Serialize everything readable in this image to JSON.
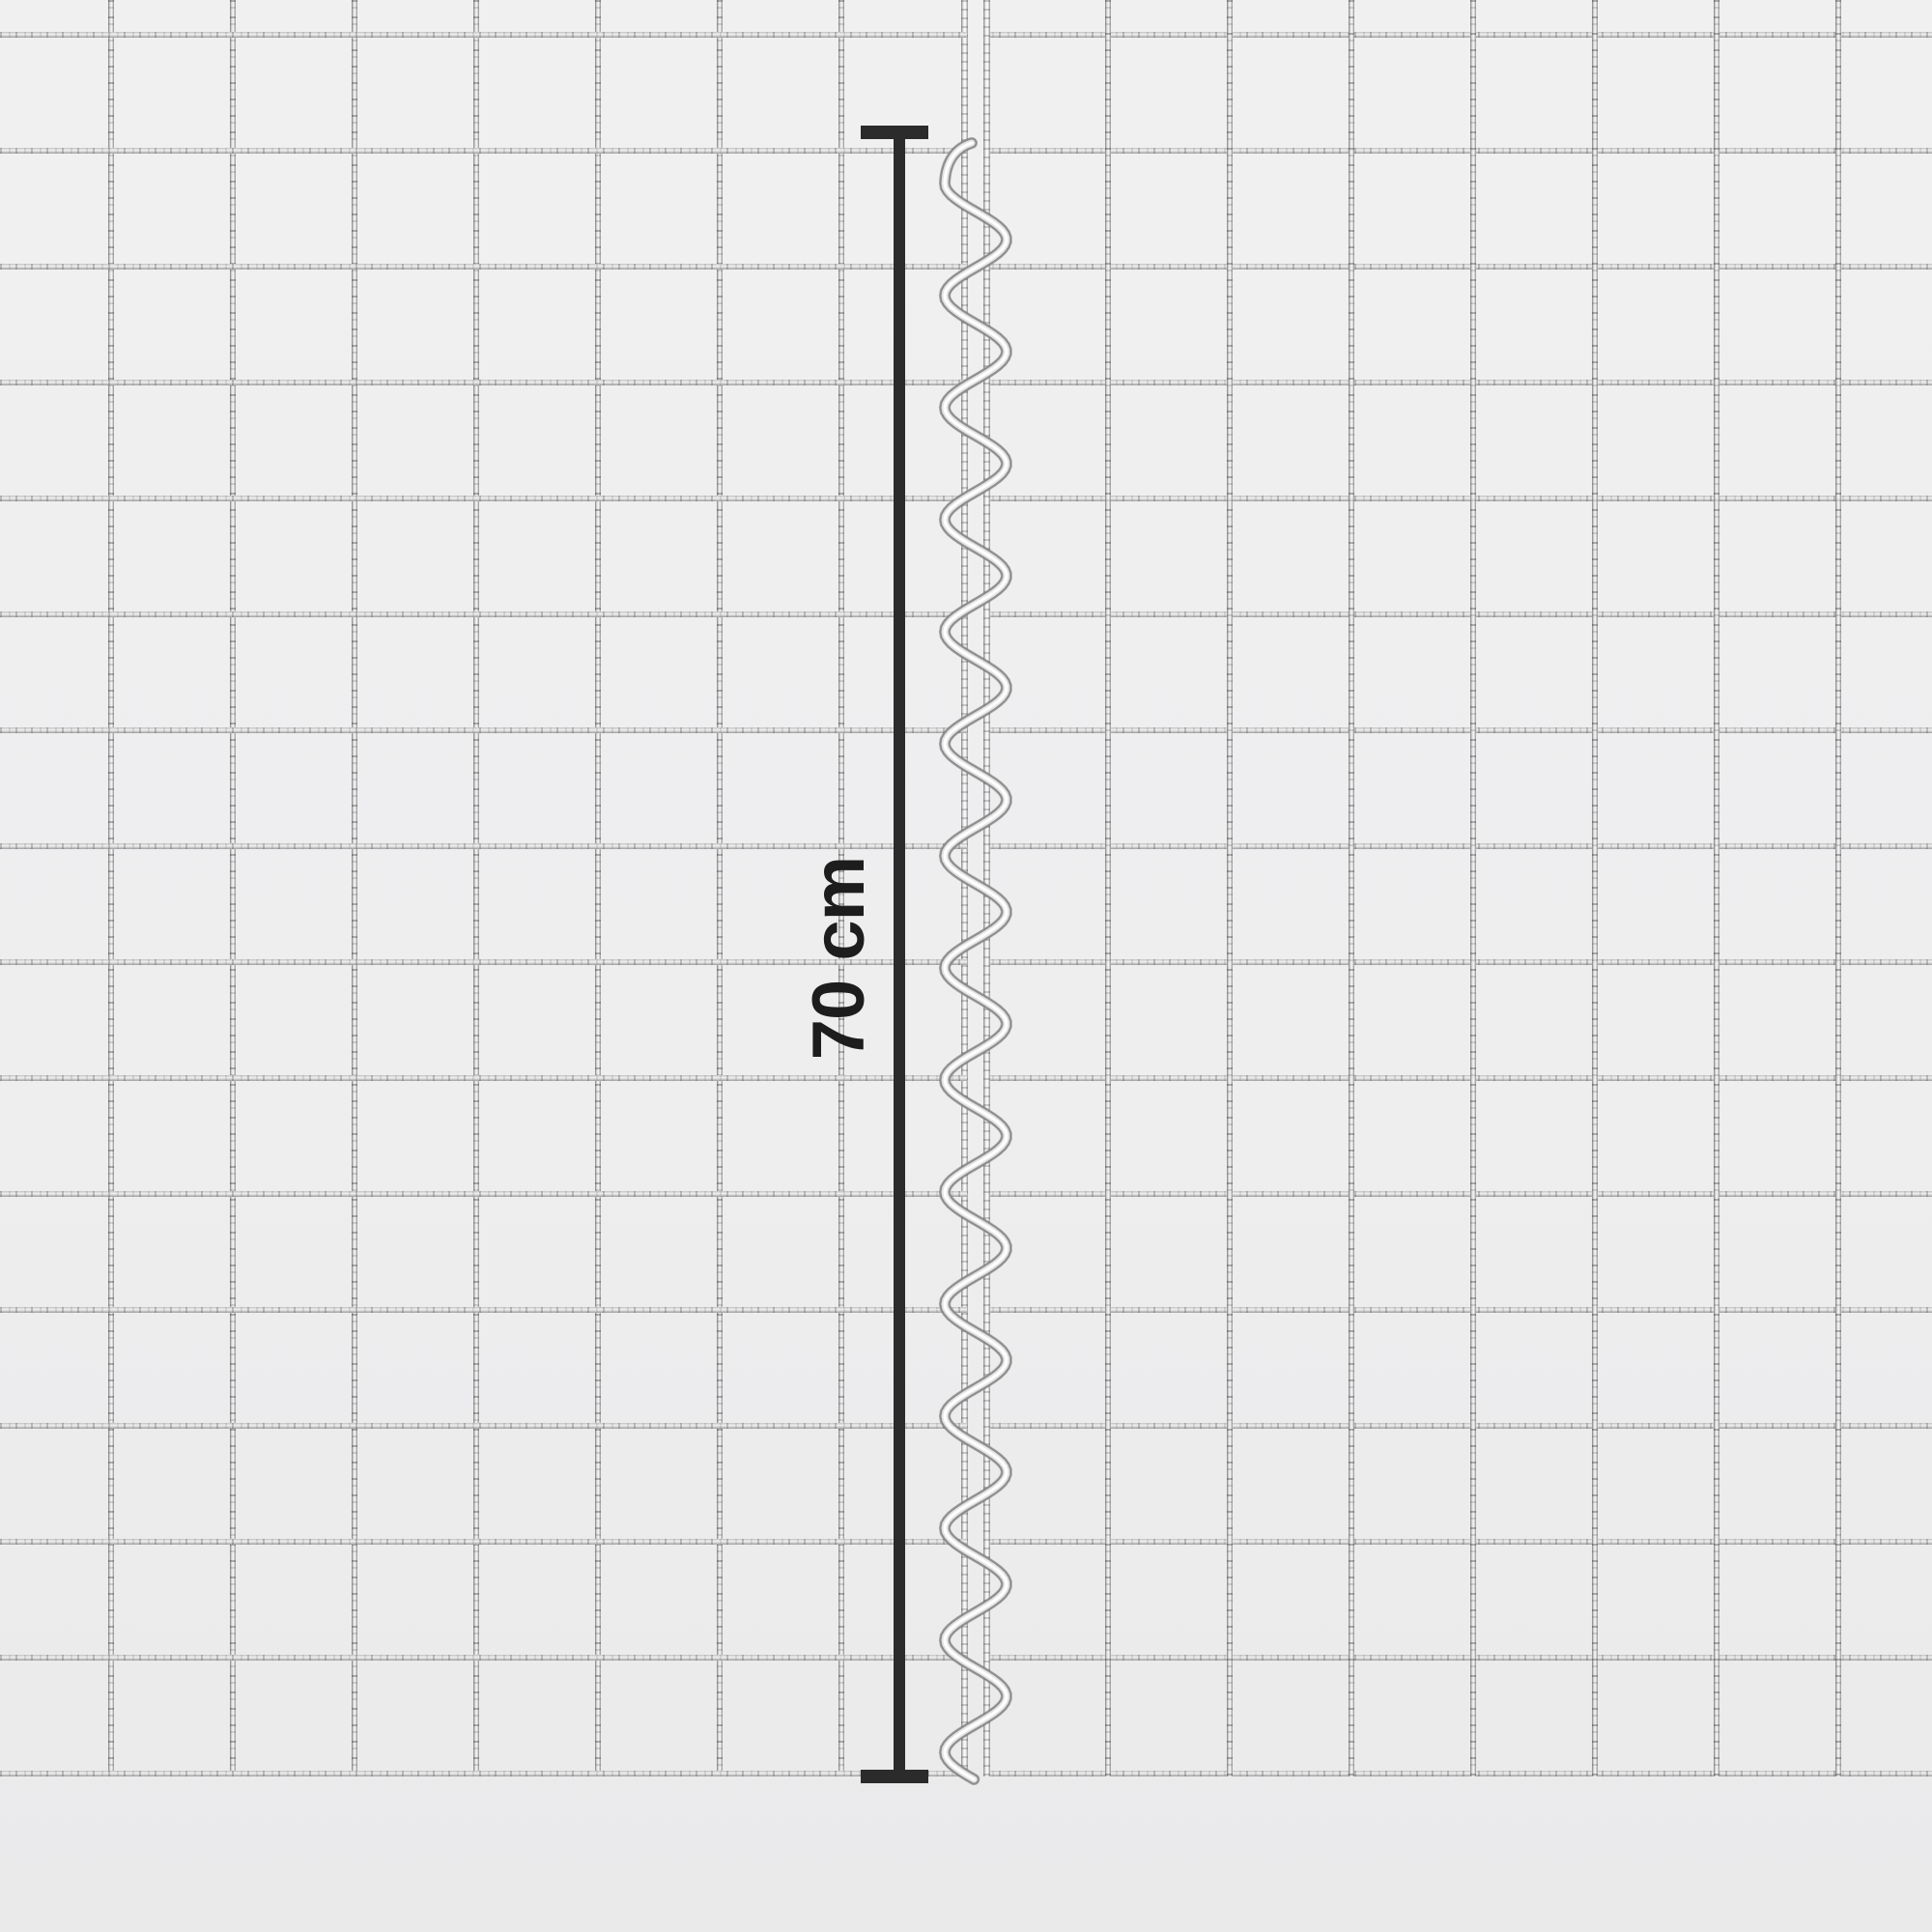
{
  "figure": {
    "subject": "Two welded wire mesh panels joined by a spiral wire connector",
    "annotation": {
      "label": "70 cm"
    },
    "colors": {
      "background": "#efeff0",
      "dimension_marker": "#2b2b2b",
      "wire_light": "#fafafa",
      "wire_mid": "#c2c2c2",
      "wire_dark": "#7e7e7e"
    }
  }
}
